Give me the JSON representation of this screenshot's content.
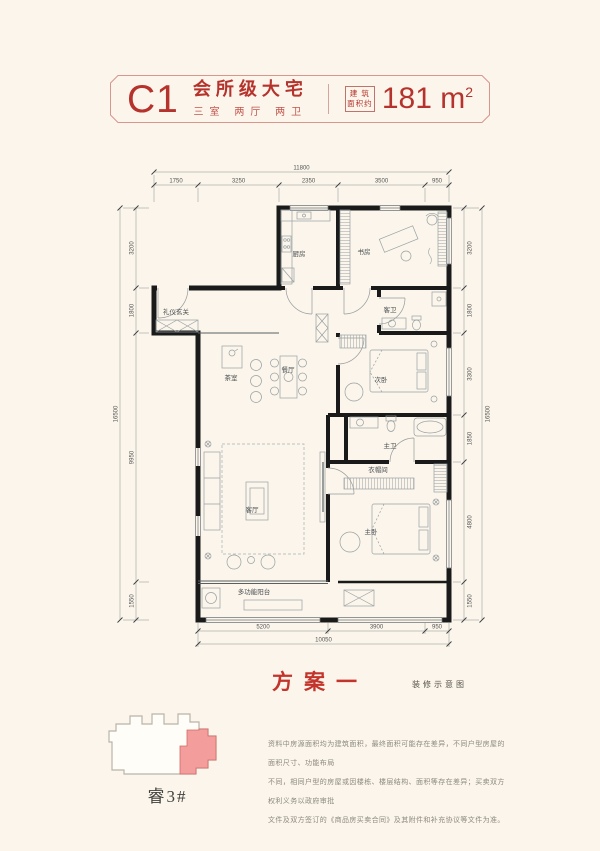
{
  "header": {
    "unit_code": "C1",
    "title": "会所级大宅",
    "subtitle": "三室 两厅 两卫",
    "area_box_line1": "建 筑",
    "area_box_line2": "面积约",
    "area_number": "181 m",
    "area_exponent": "2"
  },
  "plan": {
    "caption": "方案一",
    "caption_note": "装修示意图",
    "rooms": {
      "kitchen": "厨房",
      "study": "书房",
      "guest_bath": "客卫",
      "foyer": "礼仪玄关",
      "tea_room": "茶室",
      "dining": "餐厅",
      "bedroom2": "次卧",
      "living": "客厅",
      "master_bath": "主卫",
      "closet": "衣帽间",
      "master_bedroom": "主卧",
      "balcony": "多功能阳台"
    },
    "dims": {
      "top": {
        "total": "11800",
        "segments": [
          "1750",
          "3250",
          "2350",
          "3500",
          "950"
        ]
      },
      "left": {
        "total": "16500",
        "segments": [
          "3200",
          "1800",
          "9950",
          "1550"
        ]
      },
      "right": {
        "total": "16500",
        "segments": [
          "3200",
          "1800",
          "3300",
          "1850",
          "4800",
          "1550"
        ]
      },
      "bottom": {
        "total": "10050",
        "segments": [
          "5200",
          "3900",
          "950"
        ]
      }
    }
  },
  "keyplan": {
    "building_label": "睿3#"
  },
  "disclaimer": {
    "line1": "资料中房源面积均为建筑面积，最终面积可能存在差异，不同户型房屋的面积尺寸、功能布局",
    "line2": "不同，相同户型的房屋或因楼栋、楼层结构、面积等存在差异；买卖双方权利义务以政府审批",
    "line3": "文件及双方签订的《商品房买卖合同》及其附件和补充协议等文件为准。"
  },
  "colors": {
    "accent_red": "#b5332c",
    "highlight_pink": "#f49d9d",
    "background": "#fbf5eb",
    "wall": "#1a1a1a"
  }
}
